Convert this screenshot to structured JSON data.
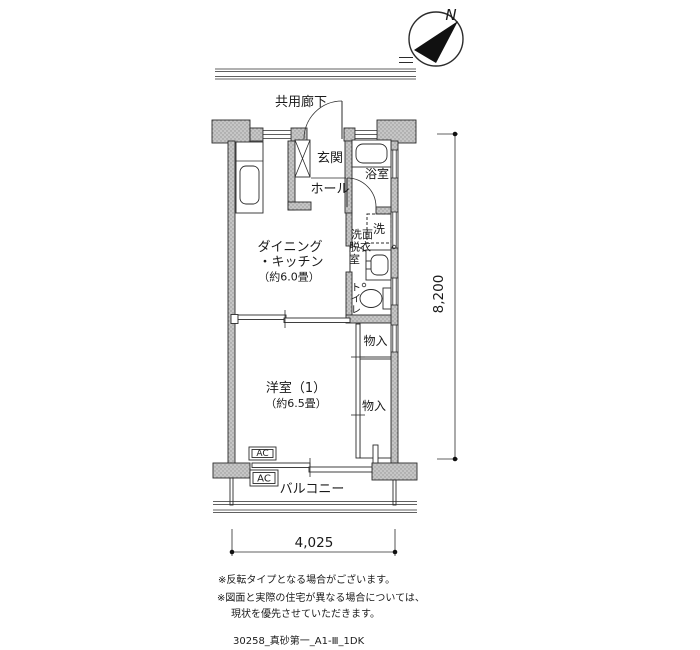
{
  "compass": {
    "north": "N"
  },
  "plan": {
    "corridor": "共用廊下",
    "rooms": {
      "entrance": "玄関",
      "hall": "ホール",
      "bath": "浴室",
      "washroom_lines": [
        "洗面",
        "脱衣",
        "室"
      ],
      "washer": "洗",
      "toilet_chars": [
        "ト",
        "イ",
        "レ"
      ],
      "dining_line1": "ダイニング",
      "dining_line2": "・キッチン",
      "dining_size": "（約6.0畳）",
      "western": "洋室（1）",
      "western_size": "（約6.5畳）",
      "closet_upper": "物入",
      "closet_lower": "物入",
      "balcony": "バルコニー",
      "ac_upper": "AC",
      "ac_lower": "AC"
    },
    "dimensions": {
      "vertical": "8,200",
      "horizontal": "4,025"
    }
  },
  "notes": {
    "line1": "※反転タイプとなる場合がございます。",
    "line2": "※図面と実際の住宅が異なる場合については、",
    "line3": "現状を優先させていただきます。"
  },
  "footer": {
    "drawing_code": "30258_真砂第一_A1-Ⅲ_1DK"
  },
  "colors": {
    "wall_fill": "#c6c6c6",
    "wall_dot": "#949494",
    "line": "#2b2b2b"
  }
}
